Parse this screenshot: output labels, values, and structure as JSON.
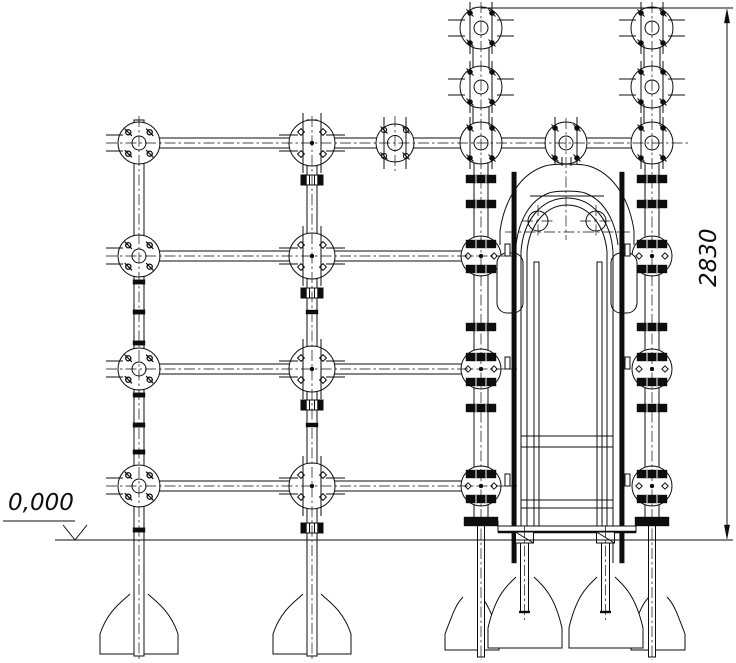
{
  "drawing": {
    "background": "#ffffff",
    "line_color": "#0d0d0d",
    "annotations": {
      "level_mark": "0,000",
      "height_dimension": "2830"
    }
  }
}
